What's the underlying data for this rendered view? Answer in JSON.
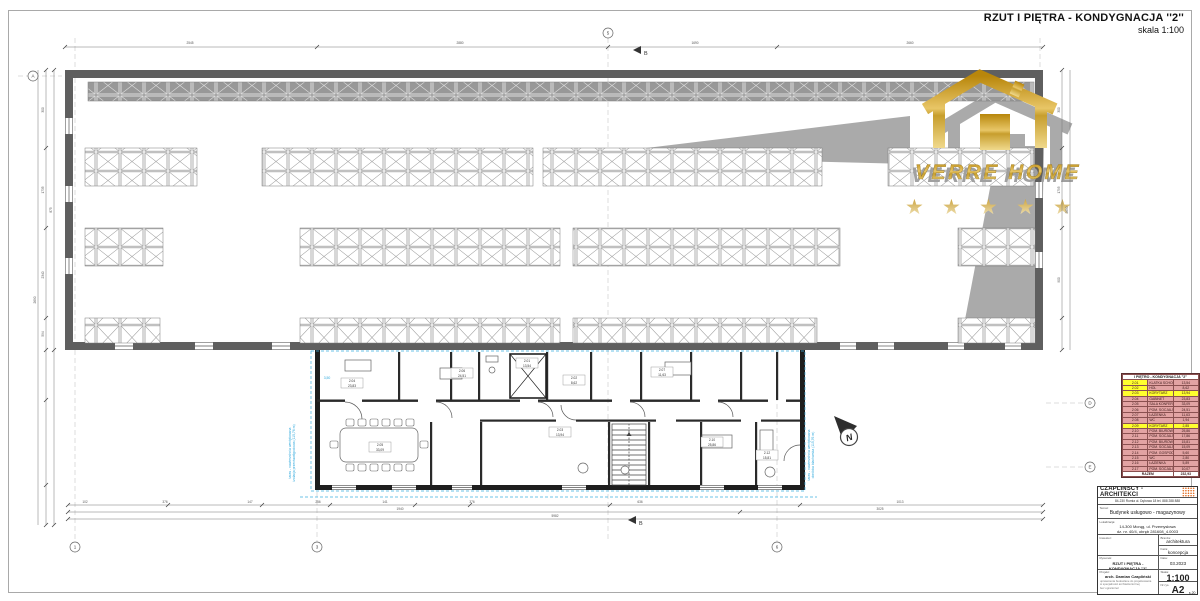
{
  "title": {
    "main": "RZUT I PIĘTRA - KONDYGNACJA ''2''",
    "scale": "skala 1:100"
  },
  "watermark": {
    "brand": "VERRE HOME",
    "star": "★"
  },
  "plan": {
    "north_label": "N",
    "section_label": "B",
    "room_labels": [
      {
        "x": 352,
        "y": 383,
        "no": "2.04",
        "area": "23,83"
      },
      {
        "x": 380,
        "y": 447,
        "no": "2.05",
        "area": "33,09"
      },
      {
        "x": 462,
        "y": 373,
        "no": "2.06",
        "area": "24,51"
      },
      {
        "x": 527,
        "y": 363,
        "no": "2.01",
        "area": "13,54"
      },
      {
        "x": 574,
        "y": 380,
        "no": "2.02",
        "area": "8,62"
      },
      {
        "x": 560,
        "y": 432,
        "no": "2.03",
        "area": "13,94"
      },
      {
        "x": 662,
        "y": 372,
        "no": "2.07",
        "area": "11,63"
      },
      {
        "x": 712,
        "y": 442,
        "no": "2.10",
        "area": "25,86"
      },
      {
        "x": 767,
        "y": 455,
        "no": "2.12",
        "area": "15,81"
      }
    ],
    "dim_labels": [
      {
        "x": 85,
        "y": 503,
        "t": "102"
      },
      {
        "x": 165,
        "y": 503,
        "t": "376"
      },
      {
        "x": 250,
        "y": 503,
        "t": "147"
      },
      {
        "x": 318,
        "y": 503,
        "t": "256"
      },
      {
        "x": 385,
        "y": 503,
        "t": "141"
      },
      {
        "x": 472,
        "y": 503,
        "t": "376"
      },
      {
        "x": 640,
        "y": 503,
        "t": "636"
      },
      {
        "x": 900,
        "y": 503,
        "t": "1013"
      },
      {
        "x": 400,
        "y": 510,
        "t": "1940"
      },
      {
        "x": 880,
        "y": 510,
        "t": "3025"
      },
      {
        "x": 555,
        "y": 517,
        "t": "5982"
      },
      {
        "x": 190,
        "y": 44,
        "t": "2545"
      },
      {
        "x": 460,
        "y": 44,
        "t": "2880"
      },
      {
        "x": 695,
        "y": 44,
        "t": "1690"
      },
      {
        "x": 910,
        "y": 44,
        "t": "2660"
      },
      {
        "x": 44,
        "y": 110,
        "t": "300",
        "r": -90
      },
      {
        "x": 44,
        "y": 190,
        "t": "1735",
        "r": -90
      },
      {
        "x": 44,
        "y": 275,
        "t": "2340",
        "r": -90
      },
      {
        "x": 44,
        "y": 334,
        "t": "594",
        "r": -90
      },
      {
        "x": 52,
        "y": 210,
        "t": "875",
        "r": -90
      },
      {
        "x": 36,
        "y": 300,
        "t": "2690",
        "r": -90
      },
      {
        "x": 1060,
        "y": 110,
        "t": "300",
        "r": -90
      },
      {
        "x": 1060,
        "y": 190,
        "t": "1795",
        "r": -90
      },
      {
        "x": 1060,
        "y": 280,
        "t": "900",
        "r": -90
      },
      {
        "x": 1068,
        "y": 210,
        "t": "2690",
        "r": -90
      }
    ],
    "axis_bubbles": [
      {
        "x": 75,
        "y": 547,
        "t": "1"
      },
      {
        "x": 317,
        "y": 547,
        "t": "3"
      },
      {
        "x": 777,
        "y": 547,
        "t": "6"
      },
      {
        "x": 608,
        "y": 33,
        "t": "5"
      },
      {
        "x": 33,
        "y": 76,
        "t": "A"
      },
      {
        "x": 1090,
        "y": 403,
        "t": "D"
      },
      {
        "x": 1090,
        "y": 467,
        "t": "E"
      }
    ],
    "blue_notes": [
      {
        "x": 291,
        "y": 453,
        "t": "taras - nawierzchnia wentylowana",
        "r": -90
      },
      {
        "x": 295,
        "y": 453,
        "t": "izolacja przeciwwilgociowa (115,76 m)",
        "r": -90
      },
      {
        "x": 810,
        "y": 455,
        "t": "taras - nawierzchnia wentylowana",
        "r": -90
      },
      {
        "x": 814,
        "y": 455,
        "t": "obróbka blacharska (115,76 m)",
        "r": -90
      },
      {
        "x": 327,
        "y": 379,
        "t": "3,50",
        "r": 0
      }
    ]
  },
  "legend": {
    "header": "I PIĘTRO - KONDYGNACJA ''2''",
    "rows": [
      {
        "no": "2.01",
        "name": "KLATKA SCHODOWA",
        "area": "13,54",
        "hl": "num"
      },
      {
        "no": "2.02",
        "name": "HOL",
        "area": "8,62",
        "hl": "num"
      },
      {
        "no": "2.03",
        "name": "KORYTARZ",
        "area": "13,94",
        "hl": "row"
      },
      {
        "no": "2.04",
        "name": "GABINET",
        "area": "23,83",
        "hl": ""
      },
      {
        "no": "2.05",
        "name": "SALA KONFERENCYJNA",
        "area": "33,09",
        "hl": ""
      },
      {
        "no": "2.06",
        "name": "POM. SOCJALNE / BIUROWE",
        "area": "24,51",
        "hl": ""
      },
      {
        "no": "2.07",
        "name": "ŁAZIENKA",
        "area": "11,63",
        "hl": ""
      },
      {
        "no": "2.08",
        "name": "WC",
        "area": "1,94",
        "hl": ""
      },
      {
        "no": "2.09",
        "name": "KORYTARZ",
        "area": "2,85",
        "hl": "row"
      },
      {
        "no": "2.10",
        "name": "POM. BIUROWE / SOCJALNE",
        "area": "25,86",
        "hl": ""
      },
      {
        "no": "2.11",
        "name": "POM. SOCJALNE / BIUROWE",
        "area": "17,86",
        "hl": ""
      },
      {
        "no": "2.12",
        "name": "POM. BIUROWE / SOCJALNE",
        "area": "15,81",
        "hl": ""
      },
      {
        "no": "2.13",
        "name": "POM. SOCJALNE / BIUROWE",
        "area": "15,09",
        "hl": ""
      },
      {
        "no": "2.14",
        "name": "POM. GOSPODARCZE",
        "area": "5,60",
        "hl": ""
      },
      {
        "no": "2.15",
        "name": "WC",
        "area": "2,80",
        "hl": ""
      },
      {
        "no": "2.16",
        "name": "ŁAZIENKA",
        "area": "5,89",
        "hl": ""
      },
      {
        "no": "2.17",
        "name": "POM. SOCJALNE",
        "area": "10,07",
        "hl": ""
      }
    ],
    "total_label": "RAZEM",
    "total": "232,93"
  },
  "titleblock": {
    "studio": "CZAPLIŃSCY - ARCHITEKCI",
    "address": "84-230 Rumia ul. Dębowa 18 tel. 888 288 888",
    "temat_label": "Temat:",
    "temat": "Budynek usługowo - magazynowy",
    "lokalizacja_label": "Lokalizacja:",
    "lokalizacja1": "14-300 Morąg, ul. Przemysłowa",
    "lokalizacja2": "dz. nr. 40/4, obręb 281608_4.0003",
    "inwestor_label": "Inwestor:",
    "branza_label": "Branża:",
    "branza": "architektura",
    "faza_label": "Faza:",
    "faza": "koncepcja",
    "rysunek_label": "Rysunek:",
    "rysunek": "RZUT I PIĘTRA - KONDYGNACJA ''2''",
    "data_label": "Data:",
    "data": "03.2023",
    "projekt_label": "Projekt:",
    "projekt": "arch. Damian Czapliński",
    "projekt_sub1": "uprawnienia budowlane do projektowania",
    "projekt_sub2": "w specjalności architektonicznej",
    "projekt_sub3": "bez ograniczeń",
    "skala_label": "Skala:",
    "skala": "1:100",
    "nr_label": "Nr rys.",
    "nr": "A2",
    "nr_sub": "s.20"
  }
}
